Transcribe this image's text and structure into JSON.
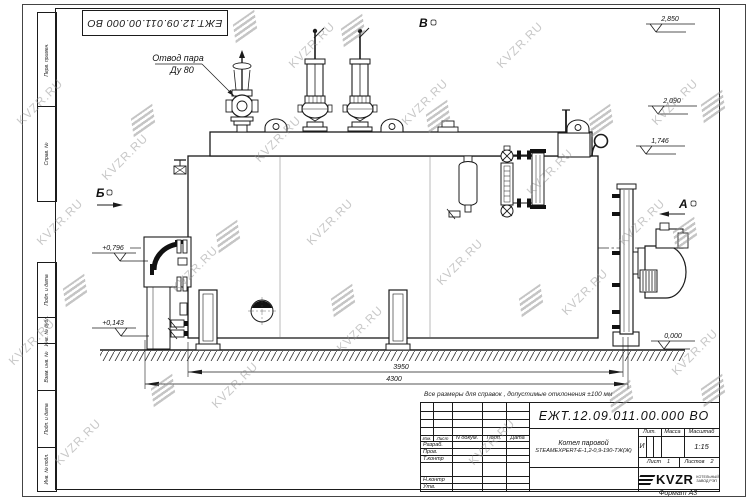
{
  "watermark": {
    "text": "KVZR.RU"
  },
  "frame": {
    "top_stamp": "ЕЖТ.12.09.011.00.000  ВО",
    "format_label": "Формат А3",
    "side_labels": [
      "Перв. примен.",
      "Справ. №",
      "Подп. и дата",
      "Инв. № дубл.",
      "Взам. инв. №",
      "Подп. и дата",
      "Инв. № подл."
    ]
  },
  "drawing": {
    "callout_line1": "Отвод пара",
    "callout_line2": "Ду 80",
    "view_top": "В",
    "view_right": "А",
    "view_left": "Б",
    "elev_2850": "2,850",
    "elev_2090": "2,090",
    "elev_1746": "1,746",
    "elev_0796": "+0,796",
    "elev_0143": "+0,143",
    "elev_0000": "0,000",
    "dim_inner": "3950",
    "dim_outer": "4300",
    "note": "Все размеры для справок , допустимые отклонения  ±100  мм"
  },
  "title_block": {
    "doc_number": "ЕЖТ.12.09.011.00.000  ВО",
    "product_name": "Котел паровой",
    "product_model": "STEAMEXPERT-Е-1,2-0,9-190-ТЖ(Ж)",
    "col_izm": "Изм.",
    "col_list": "Лист",
    "col_ndoc": "N докум.",
    "col_podp": "Подп.",
    "col_data": "Дата",
    "row_razrab": "Разраб.",
    "row_prov": "Пров.",
    "row_tkontr": "Т.контр",
    "row_nkontr": "Н.контр",
    "row_utv": "Утв.",
    "lit_label": "Лит.",
    "lit_value": "И",
    "mass_label": "Масса",
    "scale_label": "Масштаб",
    "scale_value": "1:15",
    "sheet_label": "Лист",
    "sheet_value": "1",
    "sheets_label": "Листов",
    "sheets_value": "2",
    "logo_text": "KVZR",
    "logo_line1": "КОТЕЛЬНЫЙ",
    "logo_line2": "ЗАВОД РЭП"
  }
}
